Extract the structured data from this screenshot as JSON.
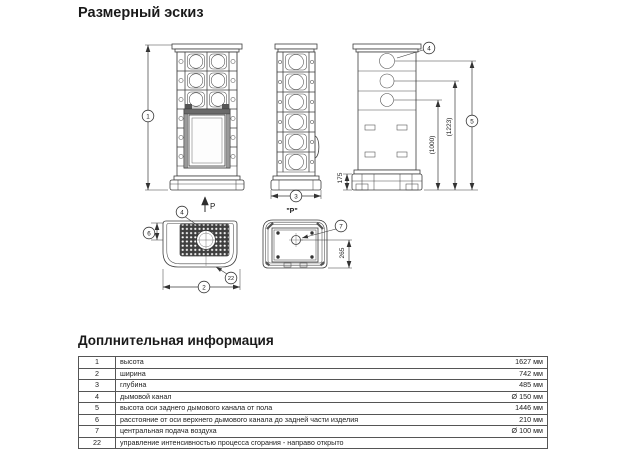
{
  "page": {
    "title": "Размерный эскиз"
  },
  "drawing": {
    "projection_arrow_label": "P",
    "projection_view_label": "\"P\"",
    "callouts": {
      "c1": "1",
      "c2": "2",
      "c3": "3",
      "c4": "4",
      "c5": "5",
      "c6": "6",
      "c7": "7",
      "c22": "22"
    },
    "dims": {
      "base_height": "175",
      "ref_1000": "(1000)",
      "ref_1223": "(1223)",
      "bottom_offset": "265"
    }
  },
  "info": {
    "title": "Доплнительная информация",
    "rows": [
      {
        "num": "1",
        "label": "высота",
        "value": "1627 мм"
      },
      {
        "num": "2",
        "label": "ширина",
        "value": "742 мм"
      },
      {
        "num": "3",
        "label": "глубина",
        "value": "485 мм"
      },
      {
        "num": "4",
        "label": "дымовой канал",
        "value": "Ø 150 мм"
      },
      {
        "num": "5",
        "label": "высота оси заднего дымового канала от пола",
        "value": "1446 мм"
      },
      {
        "num": "6",
        "label": "расстояние от оси верхнего дымового канала до задней части изделия",
        "value": "210 мм"
      },
      {
        "num": "7",
        "label": "центральная подача воздуха",
        "value": "Ø 100 мм"
      },
      {
        "num": "22",
        "label": "управление интенсивностью процесса сгорания - направо открыто",
        "value": ""
      }
    ]
  }
}
